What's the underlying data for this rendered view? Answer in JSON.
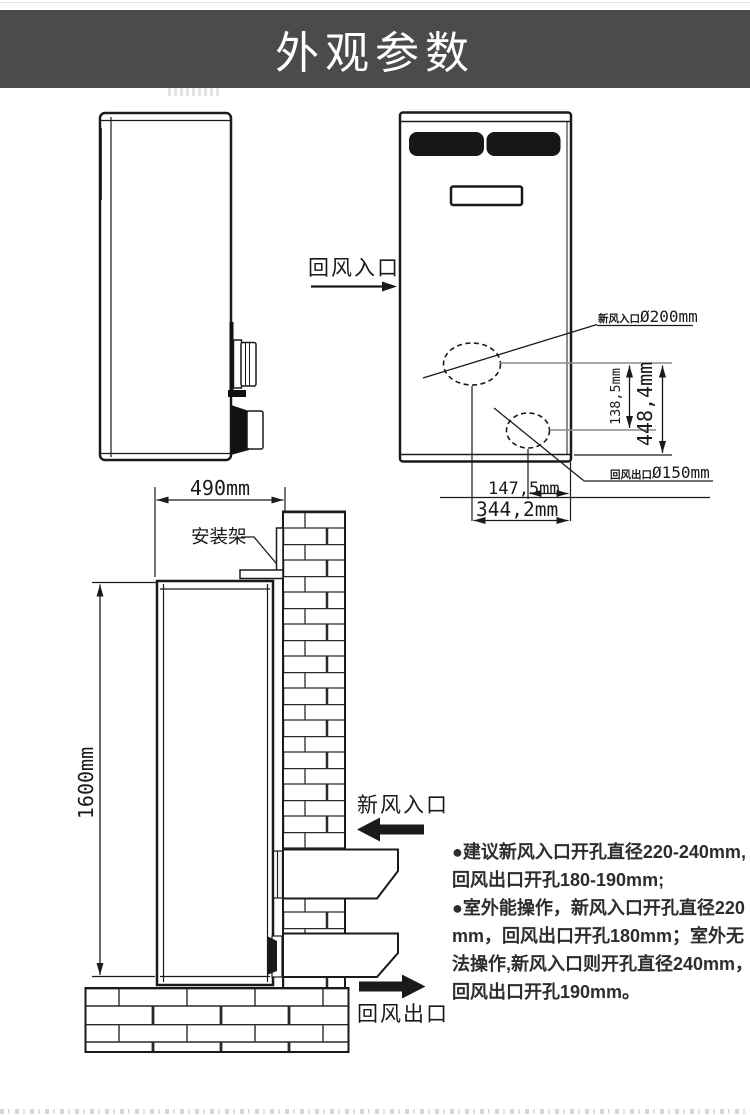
{
  "page": {
    "title": "外观参数",
    "banner_bg": "#4b4b4d",
    "line_color": "#1a1a1a",
    "grille_color": "#171717"
  },
  "front_view": {
    "return_air_inlet_label": "回风入口",
    "fresh_air_hole_label_cn": "新风入口",
    "fresh_air_hole_label_size": "Ø200mm",
    "return_air_hole_label_cn": "回风出口",
    "return_air_hole_label_size": "Ø150mm",
    "dim_circle_spacing": "138,5mm",
    "dim_bottom_to_hole": "448,4mm",
    "dim_return_offset": "147,5mm",
    "dim_fresh_offset": "344,2mm"
  },
  "installation_view": {
    "width_dim": "490mm",
    "height_dim": "1600mm",
    "bracket_label": "安装架",
    "fresh_air_inlet_label": "新风入口",
    "return_air_outlet_label": "回风出口"
  },
  "notes": {
    "lines": [
      "●建议新风入口开孔直径220-240mm,",
      "回风出口开孔180-190mm;",
      "●室外能操作，新风入口开孔直径220",
      "mm，回风出口开孔180mm；室外无",
      "法操作,新风入口则开孔直径240mm，",
      "回风出口开孔190mm。"
    ]
  }
}
